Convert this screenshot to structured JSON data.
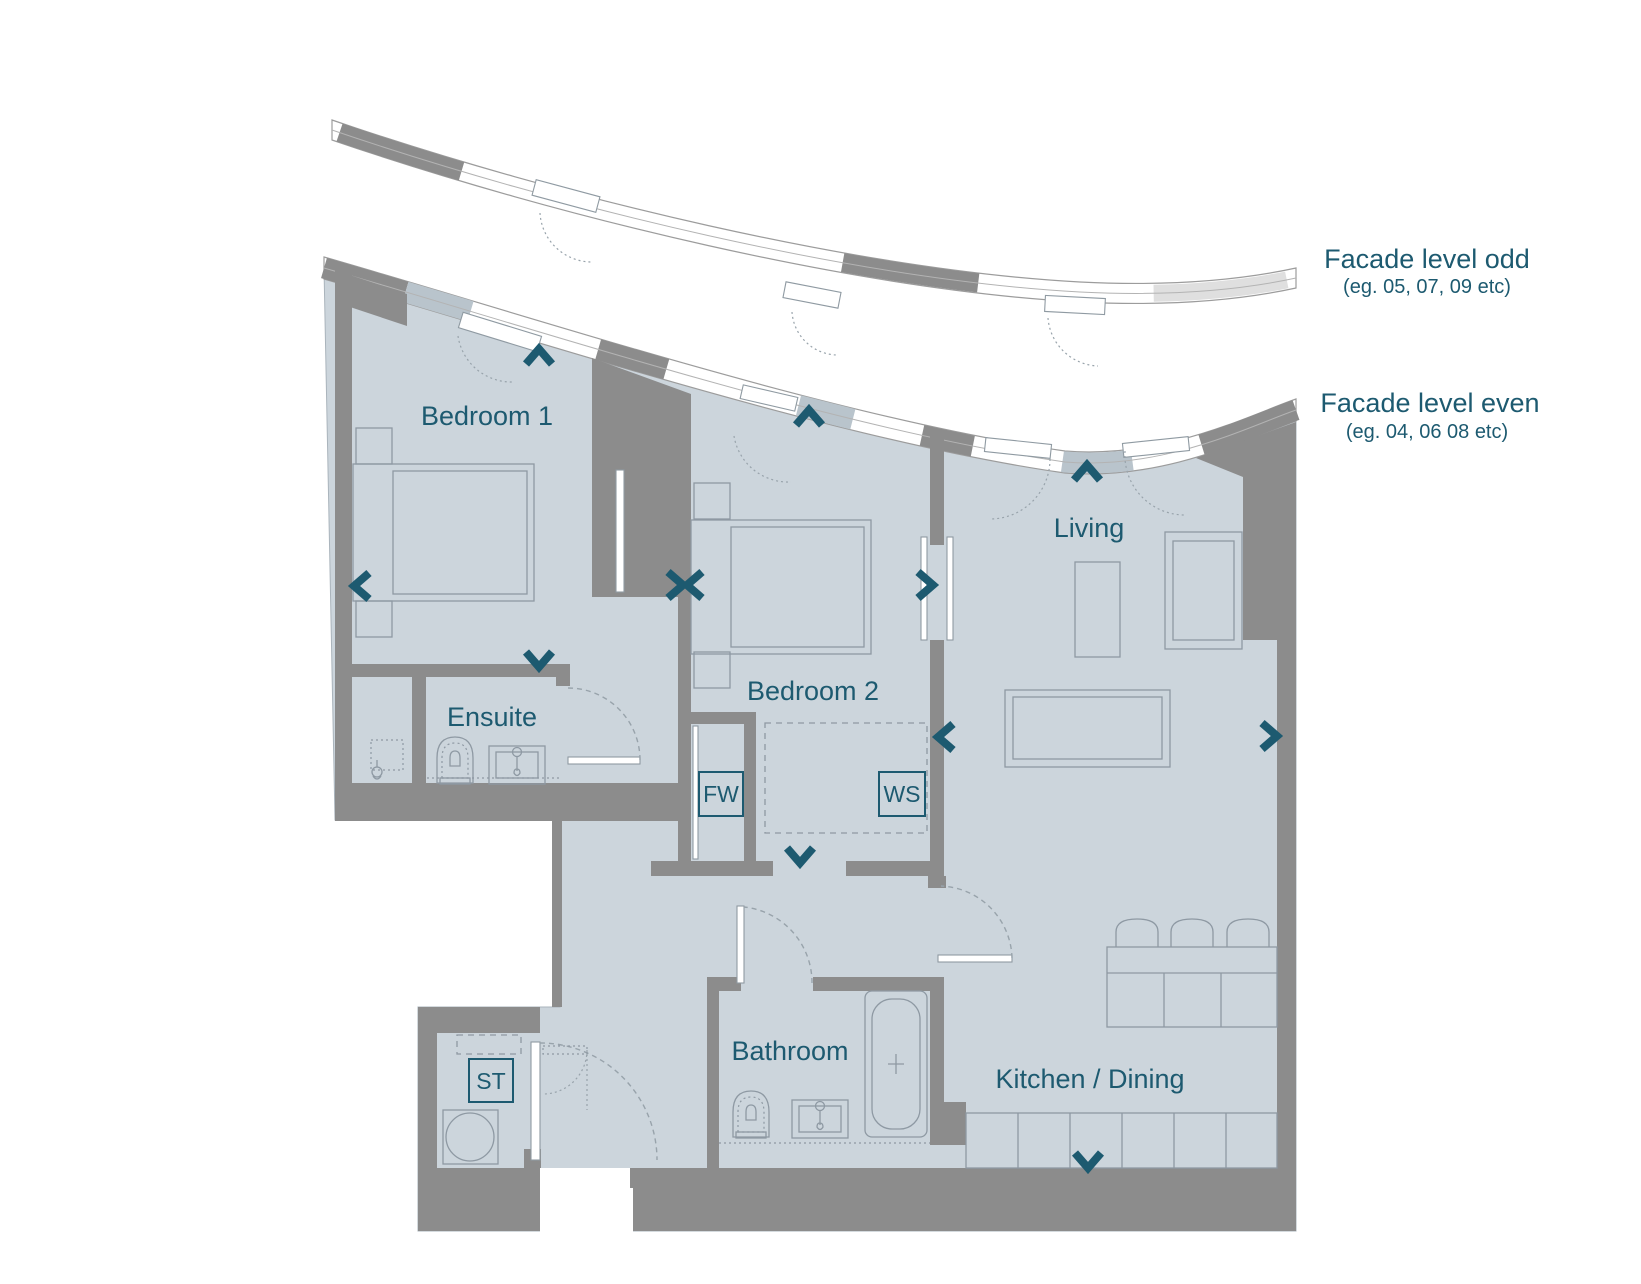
{
  "colors": {
    "bg": "#ffffff",
    "floor": "#ccd5dc",
    "wall": "#8c8c8c",
    "accent": "#1d5a70",
    "furn": "#8e99a3",
    "slab": "#b9c4cc",
    "facadeLight": "#dfdfdf",
    "arc": "#98a3ab"
  },
  "facade_annotations": {
    "odd": {
      "title": "Facade level odd",
      "subtitle": "(eg. 05, 07, 09 etc)"
    },
    "even": {
      "title": "Facade level even",
      "subtitle": "(eg. 04, 06 08 etc)"
    }
  },
  "rooms": {
    "bedroom1": "Bedroom 1",
    "bedroom2": "Bedroom 2",
    "living": "Living",
    "ensuite": "Ensuite",
    "bathroom": "Bathroom",
    "kitchen_dining": "Kitchen / Dining"
  },
  "feature_tags": {
    "fw": "FW",
    "ws": "WS",
    "st": "ST"
  }
}
